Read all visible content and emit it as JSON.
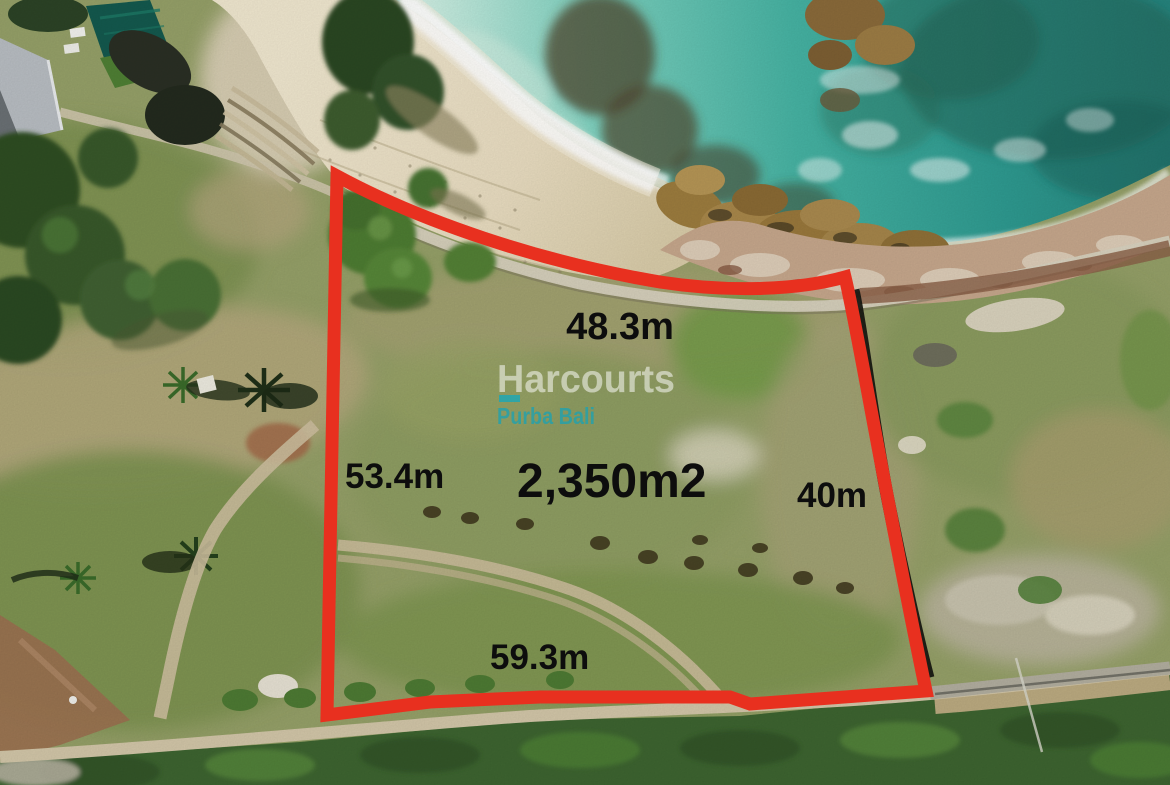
{
  "photo": {
    "type": "aerial-drone-photo",
    "subject": "Beachfront land plot with red boundary overlay"
  },
  "plot": {
    "area": "2,350m2",
    "side_top": "48.3m",
    "side_left": "53.4m",
    "side_right": "40m",
    "side_bottom": "59.3m",
    "boundary_color": "#e8301f",
    "label_color": "#0d0d0d"
  },
  "watermark": {
    "brand": "Harcourts",
    "office": "Purba Bali",
    "brand_color": "#ffffff",
    "office_color": "#18a2b4"
  },
  "palette": {
    "ocean_deep": "#27867f",
    "ocean_shallow": "#cdeee2",
    "sand": "#e9ddc1",
    "grass": "#95a068",
    "vegetation": "#3d6430",
    "rock_shore": "#c6a78c"
  }
}
